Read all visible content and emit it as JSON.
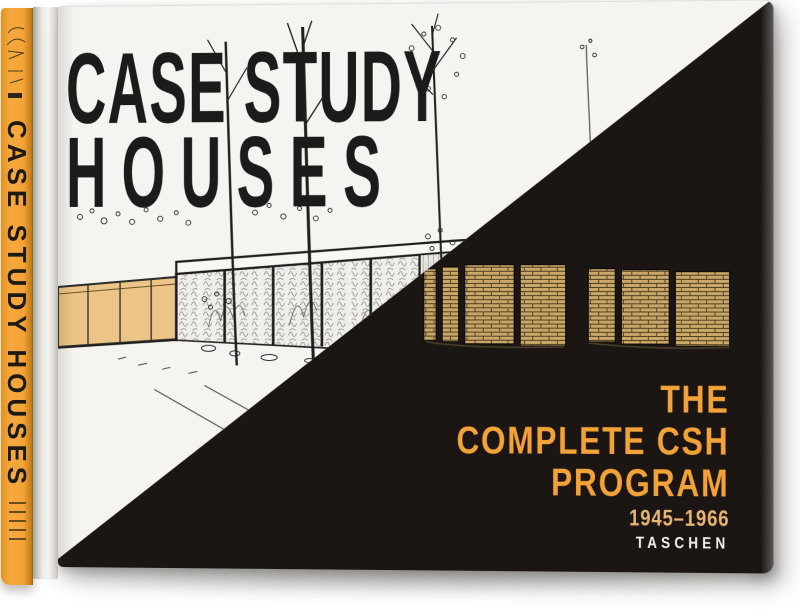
{
  "colors": {
    "spine_orange": "#f09d33",
    "accent_orange": "#f2a237",
    "years_tan": "#e9b575",
    "cover_black": "#1b1613",
    "cover_white": "#f5f4f1",
    "brick_tan": "#c9a766"
  },
  "spine": {
    "title": "CASE STUDY HOUSES"
  },
  "cover": {
    "title_line1": "CASE STUDY",
    "title_line2": "HOUSES",
    "subtitle_line1": "THE",
    "subtitle_line2": "COMPLETE CSH",
    "subtitle_line3": "PROGRAM",
    "years": "1945–1966",
    "publisher": "TASCHEN"
  }
}
